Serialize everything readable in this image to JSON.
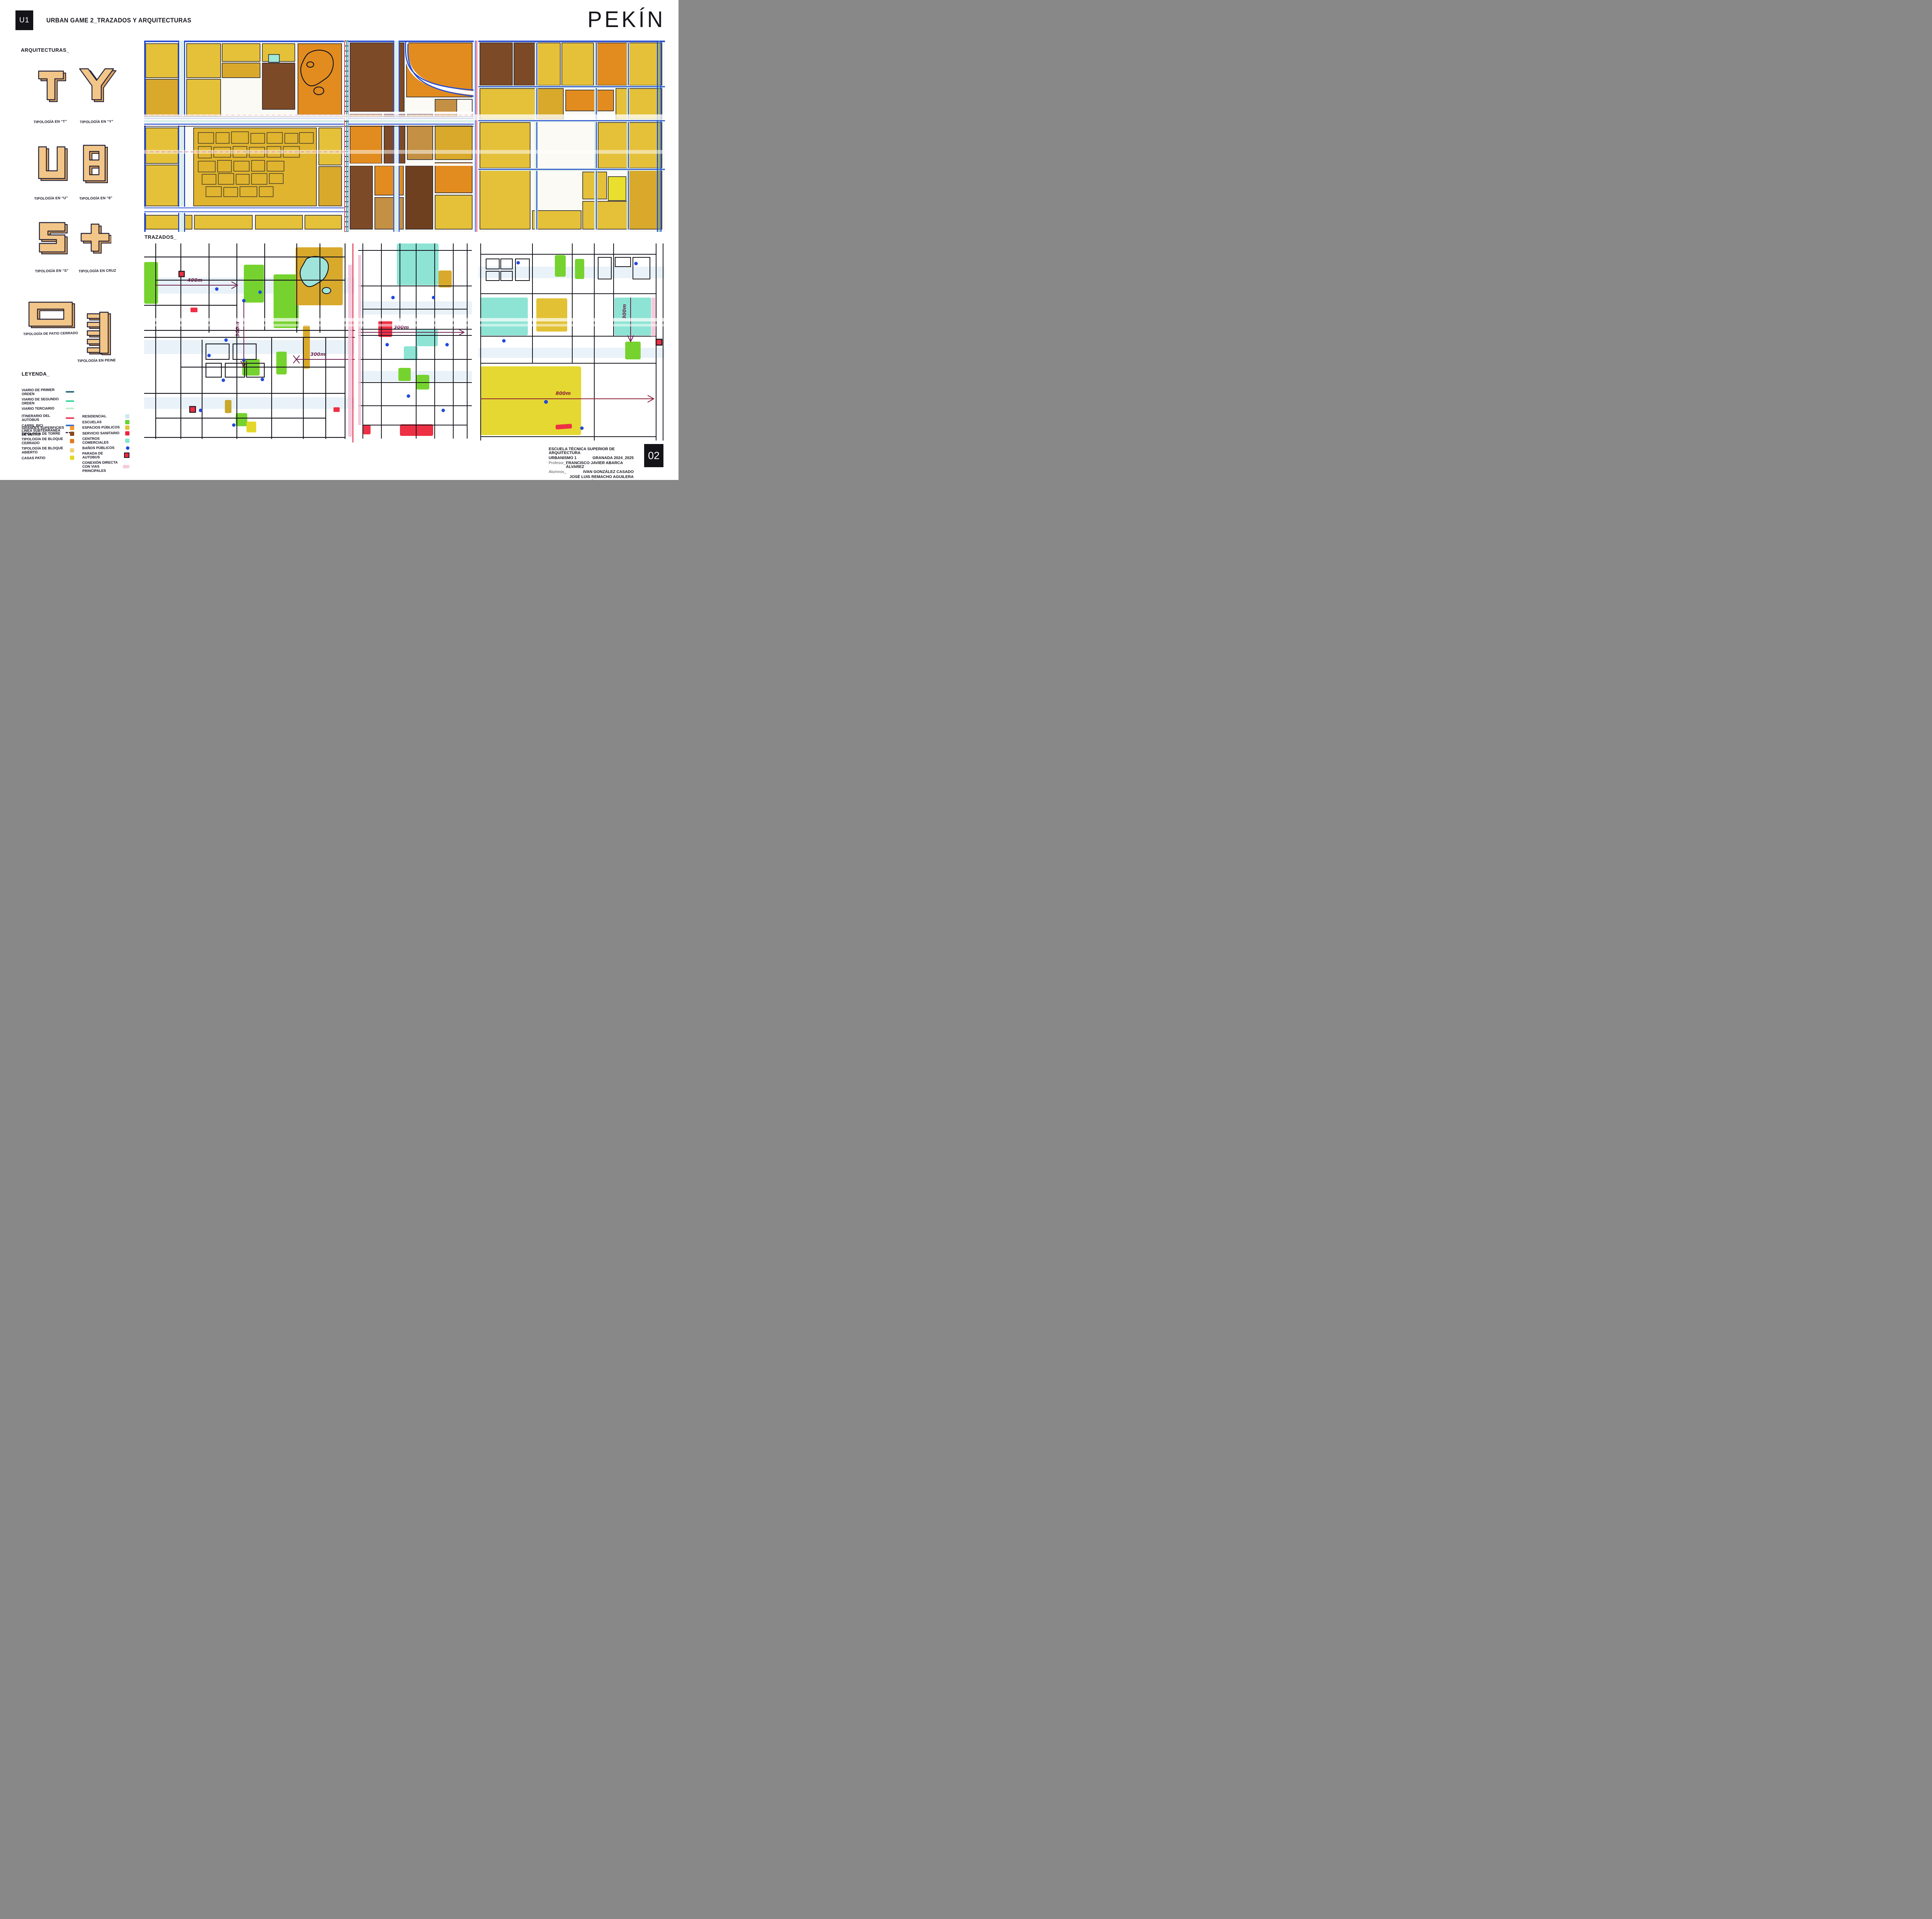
{
  "header": {
    "unit_code": "U1",
    "title": "URBAN GAME 2_TRAZADOS Y ARQUITECTURAS",
    "city_title": "PEKÍN"
  },
  "sections": {
    "arquitecturas": "ARQUITECTURAS_",
    "trazados": "TRAZADOS_",
    "leyenda": "LEYENDA_"
  },
  "typologies": [
    {
      "id": "t",
      "label": "TIPOLOGÍA EN “T”"
    },
    {
      "id": "y",
      "label": "TIPOLOGÍA EN “Y”"
    },
    {
      "id": "u",
      "label": "TIPOLOGÍA EN “U”"
    },
    {
      "id": "ocho",
      "label": "TIPOLOGÍA EN “8”"
    },
    {
      "id": "s",
      "label": "TIPOLOGÍA EN “S”"
    },
    {
      "id": "cruz",
      "label": "TIPOLOGÍA EN CRUZ"
    },
    {
      "id": "patio",
      "label": "TIPOLOGÍA DE PATIO CERRADO"
    },
    {
      "id": "peine",
      "label": "TIPOLOGÍA EN PEINE"
    }
  ],
  "legend": {
    "lines": [
      {
        "label": "VIARIO DE PRIMER ORDEN",
        "color": "#2e6b7d",
        "style": "solid"
      },
      {
        "label": "VIARIO DE SEGUNDO ORDEN",
        "color": "#35d79b",
        "style": "solid"
      },
      {
        "label": "VIARIO TERCIARIO",
        "color": "#bfeecb",
        "style": "solid"
      },
      {
        "label": "ITINERARIO DEL AUTOBUS",
        "color": "#e83a5c",
        "style": "solid"
      },
      {
        "label": "CARRIL BICI",
        "color": "#2e6fd8",
        "style": "solid"
      },
      {
        "label": "LINEA SUBTERRANEA DE METRO",
        "color": "#3c2b4f",
        "style": "dashed"
      }
    ],
    "areas_left": [
      {
        "label": "GRANDES SUPERFICIES",
        "color": "#f59b33"
      },
      {
        "label": "TIPOLOGÍA DE TORRE",
        "color": "#8a4a20"
      },
      {
        "label": "TIPOLOGÍA DE BLOQUE CERRADO",
        "color": "#e0791f"
      },
      {
        "label": "TIPOLOGÍA DE BLOQUE ABIERTO",
        "color": "#f1d07b"
      },
      {
        "label": "CASAS PATIO",
        "color": "#e2d822"
      }
    ],
    "areas_right": [
      {
        "label": "RESIDENCIAL",
        "color": "#cfe9f2",
        "shape": "square"
      },
      {
        "label": "ESCUELAS",
        "color": "#64d32f",
        "shape": "square"
      },
      {
        "label": "ESPACIOS PÚBLICOS",
        "color": "#e2c135",
        "shape": "square"
      },
      {
        "label": "SERVICIO SANITARIO",
        "color": "#f22540",
        "shape": "square"
      },
      {
        "label": "CENTROS COMERCIALES",
        "color": "#7fe8cf",
        "shape": "square"
      },
      {
        "label": "BAÑOS PÚBLICOS",
        "color": "#1747e8",
        "shape": "dot"
      },
      {
        "label": "PARADA DE AUTOBUS",
        "color": "#f2253f",
        "shape": "bordered-square"
      },
      {
        "label": "CONEXIÓN DIRECTA CON VIAS PRINCIPALES",
        "color": "#f3c3d8",
        "shape": "smudge"
      }
    ]
  },
  "maps": {
    "top_panels": 3,
    "bottom_panels": 3,
    "palette": {
      "gold": "#e5c13a",
      "dark_gold": "#d9a92c",
      "tan": "#c49043",
      "brown": "#7d4a27",
      "dark_brown": "#6f4020",
      "orange": "#e28c1f",
      "bright_yellow": "#e8df2e",
      "road_blue": "#2a4fd0",
      "road_mint": "#d9efe6",
      "water_cyan": "#9fe8dc",
      "escuelas_green": "#64d32f",
      "comercial_cyan": "#8de4d4",
      "sanitario_red": "#ee3044",
      "banos_blue": "#1f49e0",
      "arrow_purple": "#6d2350",
      "pink_crayon": "#f5bfd3",
      "rail_red": "#e0344f"
    },
    "measurements": [
      {
        "label": "400m",
        "map": "trazados-left",
        "orientation": "horizontal"
      },
      {
        "label": "300m",
        "map": "trazados-left",
        "orientation": "vertical"
      },
      {
        "label": "300m",
        "map": "trazados-left",
        "orientation": "horizontal"
      },
      {
        "label": "300m",
        "map": "trazados-center",
        "orientation": "horizontal"
      },
      {
        "label": "800m",
        "map": "trazados-right",
        "orientation": "horizontal"
      },
      {
        "label": "300m",
        "map": "trazados-right",
        "orientation": "vertical"
      }
    ]
  },
  "credits": {
    "school": "ESCUELA TÉCNICA SUPERIOR DE ARQUITECTURA",
    "course": "URBANISMO 1",
    "place_year": "GRANADA 2024_2025",
    "profesor_label": "Profesor_",
    "profesor": "FRANCISCO JAVIER ABARCA ÁLVAREZ",
    "alumnos_label": "Alumnos_",
    "alumnos": [
      "IVAN GONZÁLEZ CASADO",
      "JOSÉ LUIS REMACHO AGUILERA",
      "CARLOS RODRÍGUEZ-MANZANEQUE PLAZA"
    ],
    "page_number": "02"
  }
}
